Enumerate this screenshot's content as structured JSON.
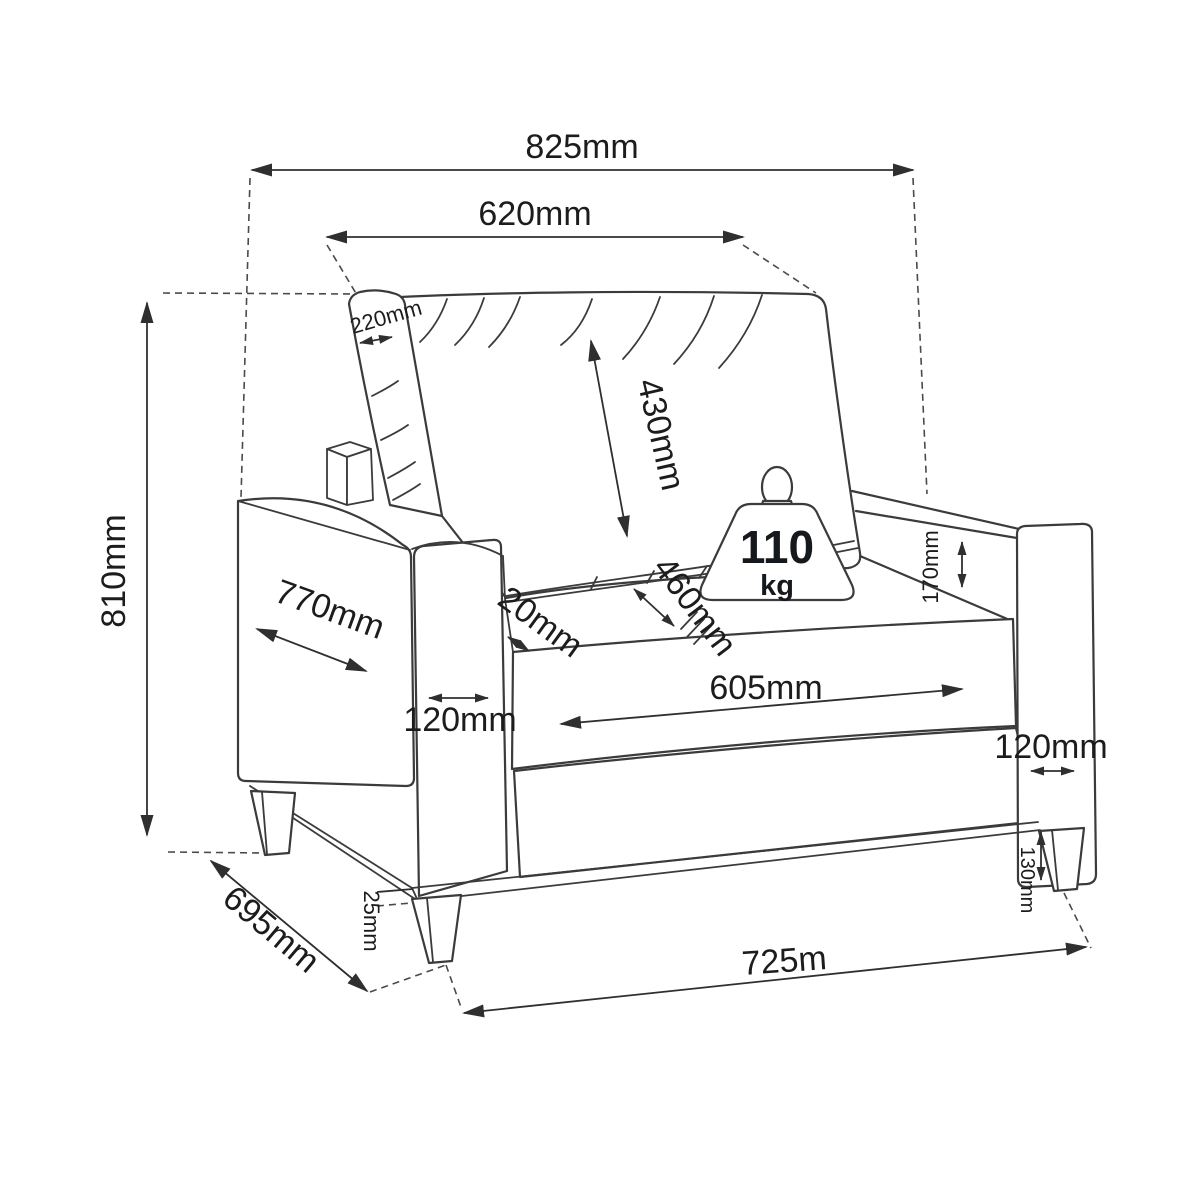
{
  "diagram": {
    "type": "furniture-dimension-diagram",
    "subject": "armchair",
    "unit": "mm",
    "line_color": "#3b3b3b",
    "text_color": "#1c1c1e",
    "background_color": "#ffffff",
    "weight_capacity": {
      "value": "110",
      "unit": "kg"
    },
    "dimensions": {
      "overall_width": "825mm",
      "backrest_width": "620mm",
      "backrest_thickness": "220mm",
      "backrest_height": "430mm",
      "overall_height": "810mm",
      "armrest_depth": "770mm",
      "left_armrest_width": "120mm",
      "seat_side_gap": "20mm",
      "seat_depth": "460mm",
      "seat_width": "605mm",
      "backrest_above_armrest": "170mm",
      "right_armrest_width": "120mm",
      "base_rail_thickness": "25mm",
      "leg_height": "130mm",
      "overall_depth": "695mm",
      "front_width": "725m"
    }
  }
}
